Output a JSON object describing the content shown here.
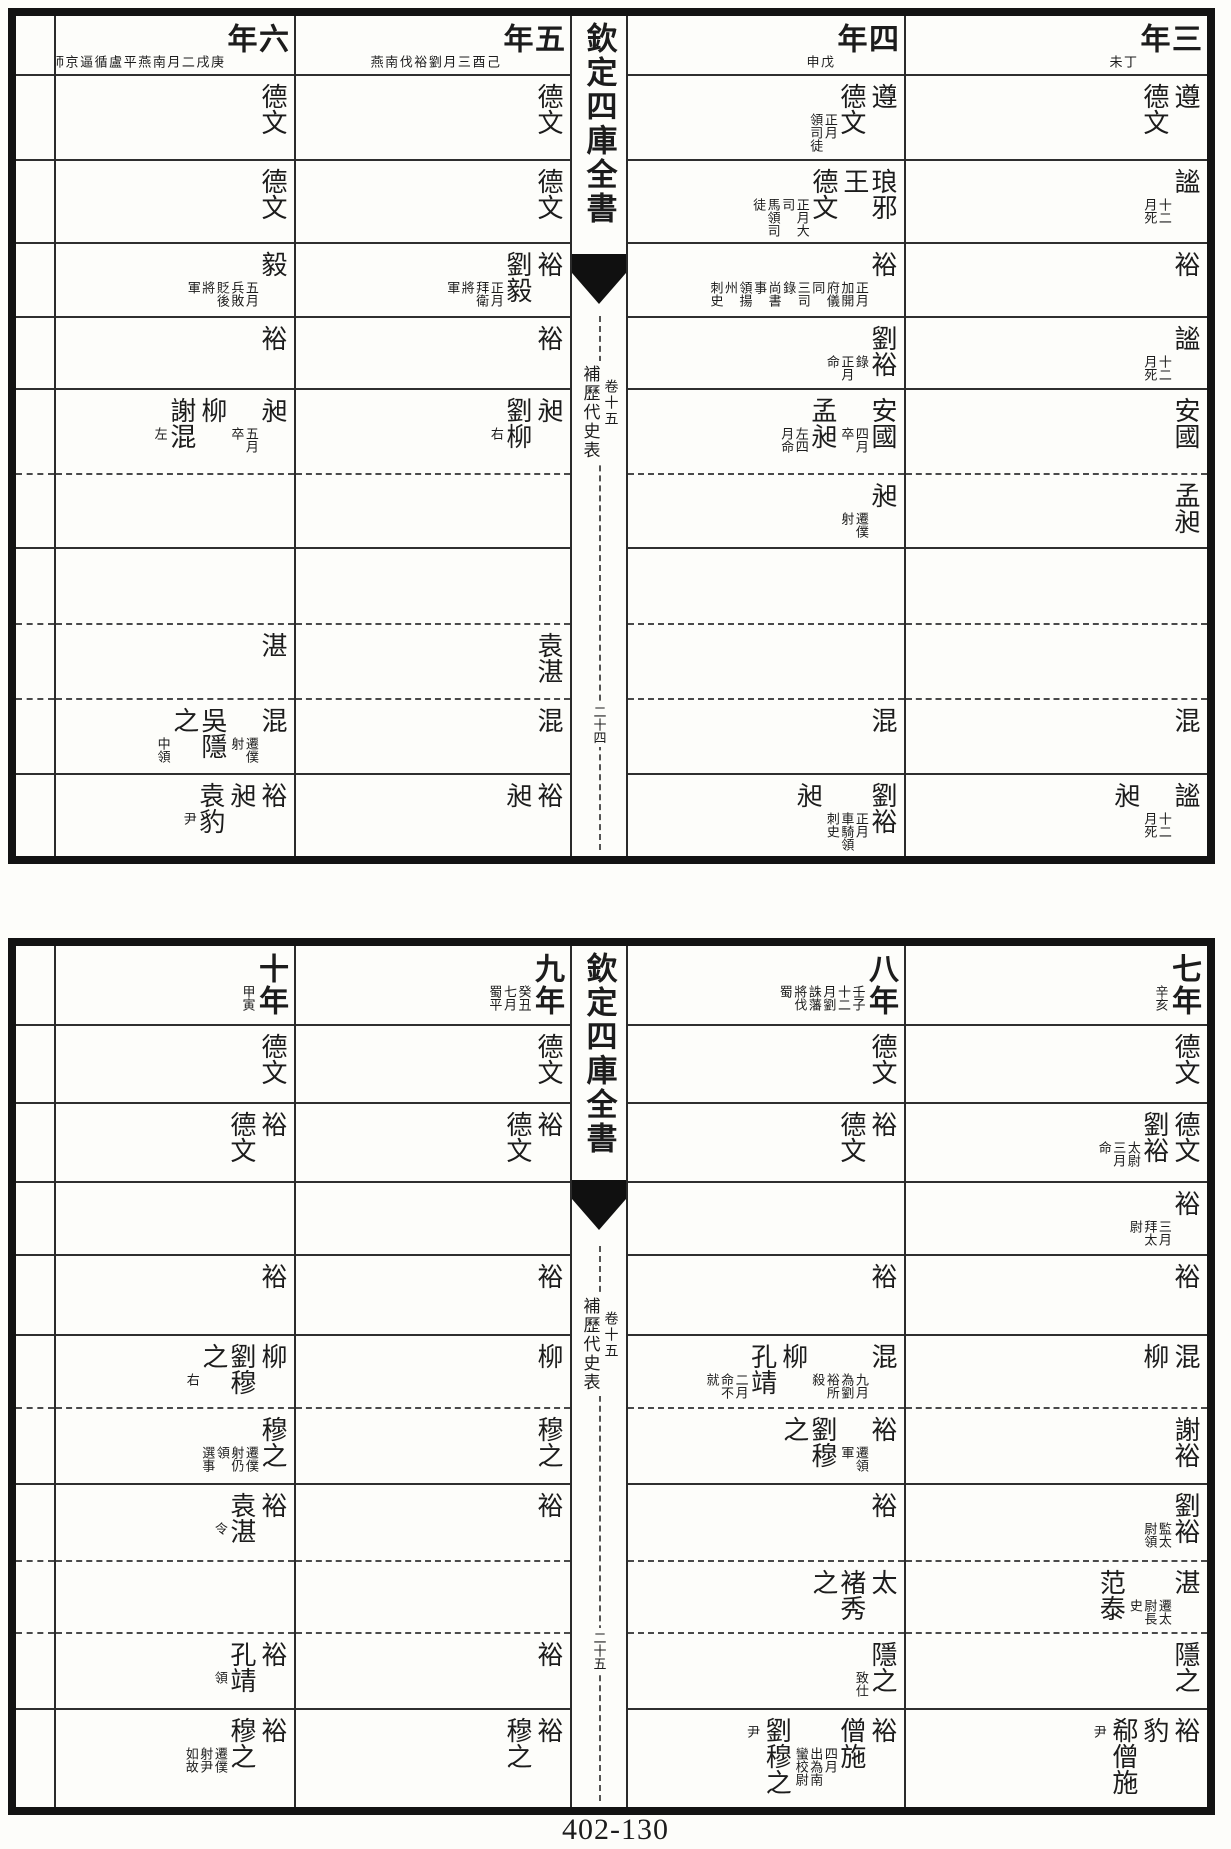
{
  "page_number": "402-130",
  "ink_color": "#1c1c1c",
  "blocks": [
    {
      "spine": {
        "title": "欽定四庫全書",
        "series": "補歷代史表",
        "volume": "卷十五",
        "folio": "二十四"
      },
      "columns": [
        {
          "year": "三年",
          "notes": [
            "丁未"
          ],
          "rows": [
            [
              {
                "b": "遵"
              },
              {
                "b": "德文"
              }
            ],
            [
              {
                "b": "謐",
                "s": [
                  "十二",
                  "月死"
                ]
              }
            ],
            [
              {
                "b": "裕"
              }
            ],
            [
              {
                "b": "謐",
                "s": [
                  "十二",
                  "月死"
                ]
              }
            ],
            [
              {
                "b": "安國"
              }
            ],
            [
              {
                "b": "孟昶"
              }
            ],
            [],
            [],
            [
              {
                "b": "混"
              }
            ],
            [
              {
                "b": "謐",
                "s": [
                  "十二",
                  "月死"
                ]
              },
              {
                "b": "昶"
              }
            ]
          ]
        },
        {
          "year": "四年",
          "notes": [
            "戊申"
          ],
          "rows": [
            [
              {
                "b": "遵"
              },
              {
                "b": "德文",
                "s": [
                  "正月",
                  "領司徒"
                ]
              }
            ],
            [
              {
                "b": "琅邪王"
              },
              {
                "b": "德文",
                "s": [
                  "正月大司",
                  "馬領司徒"
                ]
              }
            ],
            [
              {
                "b": "裕",
                "s": [
                  "正月加開",
                  "府儀同",
                  "三司錄",
                  "尚書事",
                  "領揚州",
                  "刺史"
                ]
              }
            ],
            [
              {
                "b": "劉裕",
                "s": [
                  "錄",
                  "正月命"
                ]
              }
            ],
            [
              {
                "b": "安國",
                "s": [
                  "四月",
                  "卒"
                ]
              },
              {
                "b": "孟昶",
                "s": [
                  "左四",
                  "月命"
                ]
              }
            ],
            [
              {
                "b": "昶",
                "s": [
                  "遷僕",
                  "射"
                ]
              }
            ],
            [],
            [],
            [
              {
                "b": "混"
              }
            ],
            [
              {
                "b": "劉裕",
                "s": [
                  "正月",
                  "車騎領",
                  "刺史"
                ]
              },
              {
                "b": "昶"
              }
            ]
          ]
        },
        {
          "year": "五年",
          "notes": [
            "己酉三月",
            "劉裕伐南",
            "燕"
          ],
          "rows": [
            [
              {
                "b": "德文"
              }
            ],
            [
              {
                "b": "德文"
              }
            ],
            [
              {
                "b": "裕"
              },
              {
                "b": "劉毅",
                "s": [
                  "正月",
                  "拜衛將",
                  "軍"
                ]
              }
            ],
            [
              {
                "b": "裕"
              }
            ],
            [
              {
                "b": "昶"
              },
              {
                "b": "劉柳",
                "s": [
                  "右"
                ]
              }
            ],
            [],
            [],
            [
              {
                "b": "袁湛"
              }
            ],
            [
              {
                "b": "混"
              }
            ],
            [
              {
                "b": "裕"
              },
              {
                "b": "昶"
              }
            ]
          ]
        },
        {
          "year": "六年",
          "notes": [
            "庚戌二月",
            "南燕平盧",
            "循逼京師",
            "七月敗還",
            "廣州"
          ],
          "rows": [
            [
              {
                "b": "德文"
              }
            ],
            [
              {
                "b": "德文"
              }
            ],
            [
              {
                "b": "毅",
                "s": [
                  "五月",
                  "兵敗",
                  "貶後將",
                  "軍"
                ]
              }
            ],
            [
              {
                "b": "裕"
              }
            ],
            [
              {
                "b": "昶",
                "s": [
                  "五月",
                  "卒"
                ]
              },
              {
                "b": "柳"
              },
              {
                "b": "謝混",
                "s": [
                  "左"
                ]
              }
            ],
            [],
            [],
            [
              {
                "b": "湛"
              }
            ],
            [
              {
                "b": "混",
                "s": [
                  "遷僕",
                  "射"
                ]
              },
              {
                "b": "吳隱之",
                "s": [
                  "中領"
                ]
              }
            ],
            [
              {
                "b": "裕"
              },
              {
                "b": "昶"
              },
              {
                "b": "袁豹",
                "s": [
                  "尹"
                ]
              }
            ]
          ]
        }
      ]
    },
    {
      "spine": {
        "title": "欽定四庫全書",
        "series": "補歷代史表",
        "volume": "卷十五",
        "folio": "二十五"
      },
      "columns": [
        {
          "year": "七年",
          "notes": [
            "辛亥"
          ],
          "rows": [
            [
              {
                "b": "德文"
              }
            ],
            [
              {
                "b": "德文"
              },
              {
                "b": "劉裕",
                "s": [
                  "太尉",
                  "三月命"
                ]
              }
            ],
            [
              {
                "b": "裕",
                "s": [
                  "三月",
                  "拜太",
                  "尉"
                ]
              }
            ],
            [
              {
                "b": "裕"
              }
            ],
            [
              {
                "b": "混"
              },
              {
                "b": "柳"
              }
            ],
            [
              {
                "b": "謝裕"
              }
            ],
            [
              {
                "b": "劉裕",
                "s": [
                  "監太",
                  "尉領"
                ]
              }
            ],
            [
              {
                "b": "湛",
                "s": [
                  "遷太",
                  "尉長",
                  "史"
                ]
              },
              {
                "b": "范泰"
              }
            ],
            [
              {
                "b": "隱之"
              }
            ],
            [
              {
                "b": "裕"
              },
              {
                "b": "豹"
              },
              {
                "b": "郗僧施"
              },
              {
                "s": [
                  "尹"
                ]
              }
            ]
          ]
        },
        {
          "year": "八年",
          "notes": [
            "壬子十二",
            "月劉誅藩",
            "將伐蜀"
          ],
          "rows": [
            [
              {
                "b": "德文"
              }
            ],
            [
              {
                "b": "裕"
              },
              {
                "b": "德文"
              }
            ],
            [],
            [
              {
                "b": "裕"
              }
            ],
            [
              {
                "b": "混",
                "s": [
                  "九月為劉",
                  "裕所殺"
                ]
              },
              {
                "b": "柳"
              },
              {
                "b": "孔靖",
                "s": [
                  "二月",
                  "命不就"
                ]
              }
            ],
            [
              {
                "b": "裕",
                "s": [
                  "遷領",
                  "軍"
                ]
              },
              {
                "b": "劉穆之"
              }
            ],
            [
              {
                "b": "裕"
              }
            ],
            [
              {
                "b": "太"
              },
              {
                "b": "褚秀之"
              }
            ],
            [
              {
                "b": "隱之",
                "s": [
                  "致仕"
                ]
              }
            ],
            [
              {
                "b": "裕"
              },
              {
                "b": "僧施",
                "s": [
                  "四月",
                  "出為南",
                  "蠻校尉"
                ]
              },
              {
                "b": "劉穆之"
              },
              {
                "s": [
                  "尹"
                ]
              }
            ]
          ]
        },
        {
          "year": "九年",
          "notes": [
            "癸丑七月",
            "蜀平"
          ],
          "rows": [
            [
              {
                "b": "德文"
              }
            ],
            [
              {
                "b": "裕"
              },
              {
                "b": "德文"
              }
            ],
            [],
            [
              {
                "b": "裕"
              }
            ],
            [
              {
                "b": "柳"
              }
            ],
            [
              {
                "b": "穆之"
              }
            ],
            [
              {
                "b": "裕"
              }
            ],
            [],
            [
              {
                "b": "裕"
              }
            ],
            [
              {
                "b": "裕"
              },
              {
                "b": "穆之"
              }
            ]
          ]
        },
        {
          "year": "十年",
          "notes": [
            "甲寅"
          ],
          "rows": [
            [
              {
                "b": "德文"
              }
            ],
            [
              {
                "b": "裕"
              },
              {
                "b": "德文"
              }
            ],
            [],
            [
              {
                "b": "裕"
              }
            ],
            [
              {
                "b": "柳"
              },
              {
                "b": "劉穆之",
                "s": [
                  "右"
                ]
              }
            ],
            [
              {
                "b": "穆之",
                "s": [
                  "遷僕",
                  "射仍領",
                  "選事"
                ]
              }
            ],
            [
              {
                "b": "裕"
              },
              {
                "b": "袁湛",
                "s": [
                  "令"
                ]
              }
            ],
            [],
            [
              {
                "b": "裕"
              },
              {
                "b": "孔靖",
                "s": [
                  "領"
                ]
              }
            ],
            [
              {
                "b": "裕"
              },
              {
                "b": "穆之",
                "s": [
                  "遷僕",
                  "射尹",
                  "如故"
                ]
              }
            ]
          ]
        }
      ]
    }
  ]
}
